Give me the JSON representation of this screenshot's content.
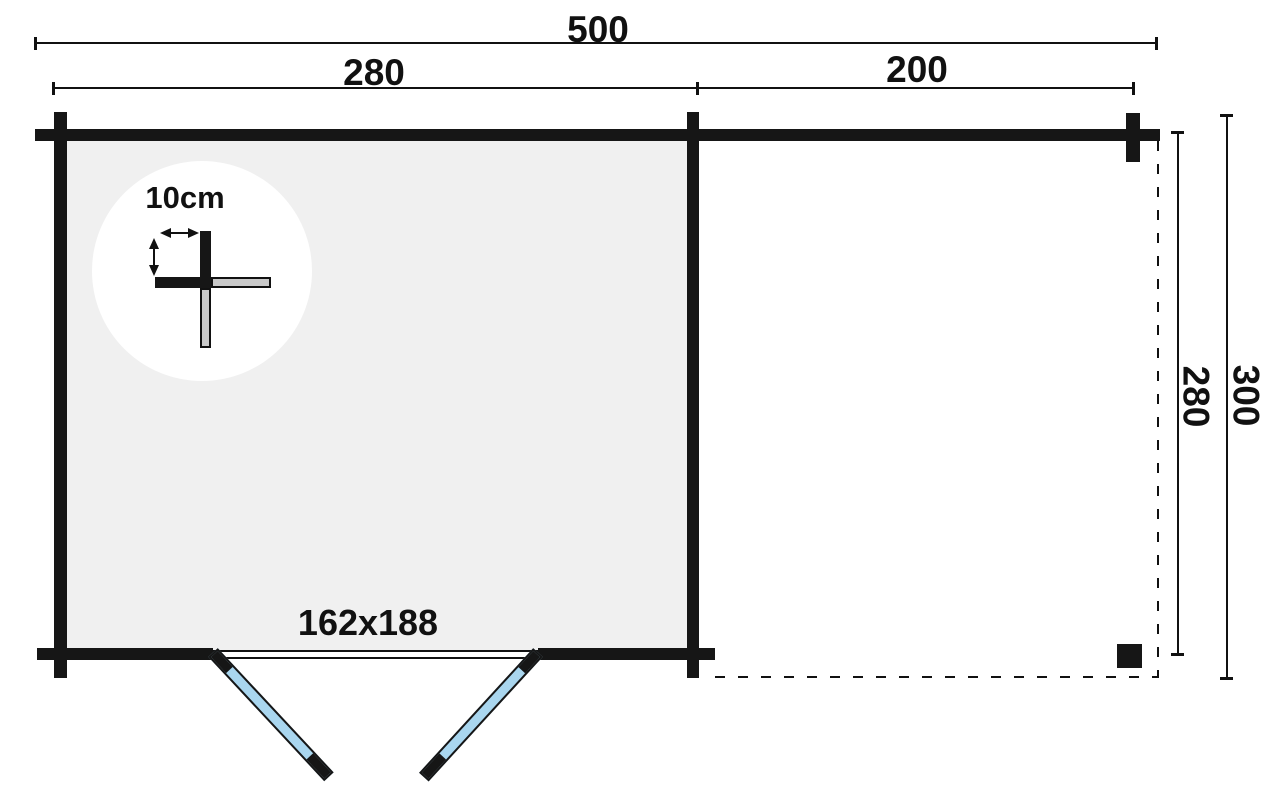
{
  "diagram": {
    "type": "floor-plan",
    "dimensions": {
      "overall_width": "500",
      "main_room_width": "280",
      "canopy_width": "200",
      "inner_depth": "280",
      "overall_depth": "300",
      "door_size": "162x188",
      "wall_thickness": "10cm"
    }
  },
  "icons": {
    "thickness_width_arrow": "double-arrow-horizontal-icon",
    "thickness_height_arrow": "double-arrow-vertical-icon"
  },
  "colors": {
    "background": "#ffffff",
    "line": "#111111",
    "wall": "#161616",
    "room_fill": "#f0f0f0",
    "detail_circle_fill": "#ffffff",
    "log_end_fill": "#c9c9c9",
    "door_fill": "#a9d6ef"
  }
}
